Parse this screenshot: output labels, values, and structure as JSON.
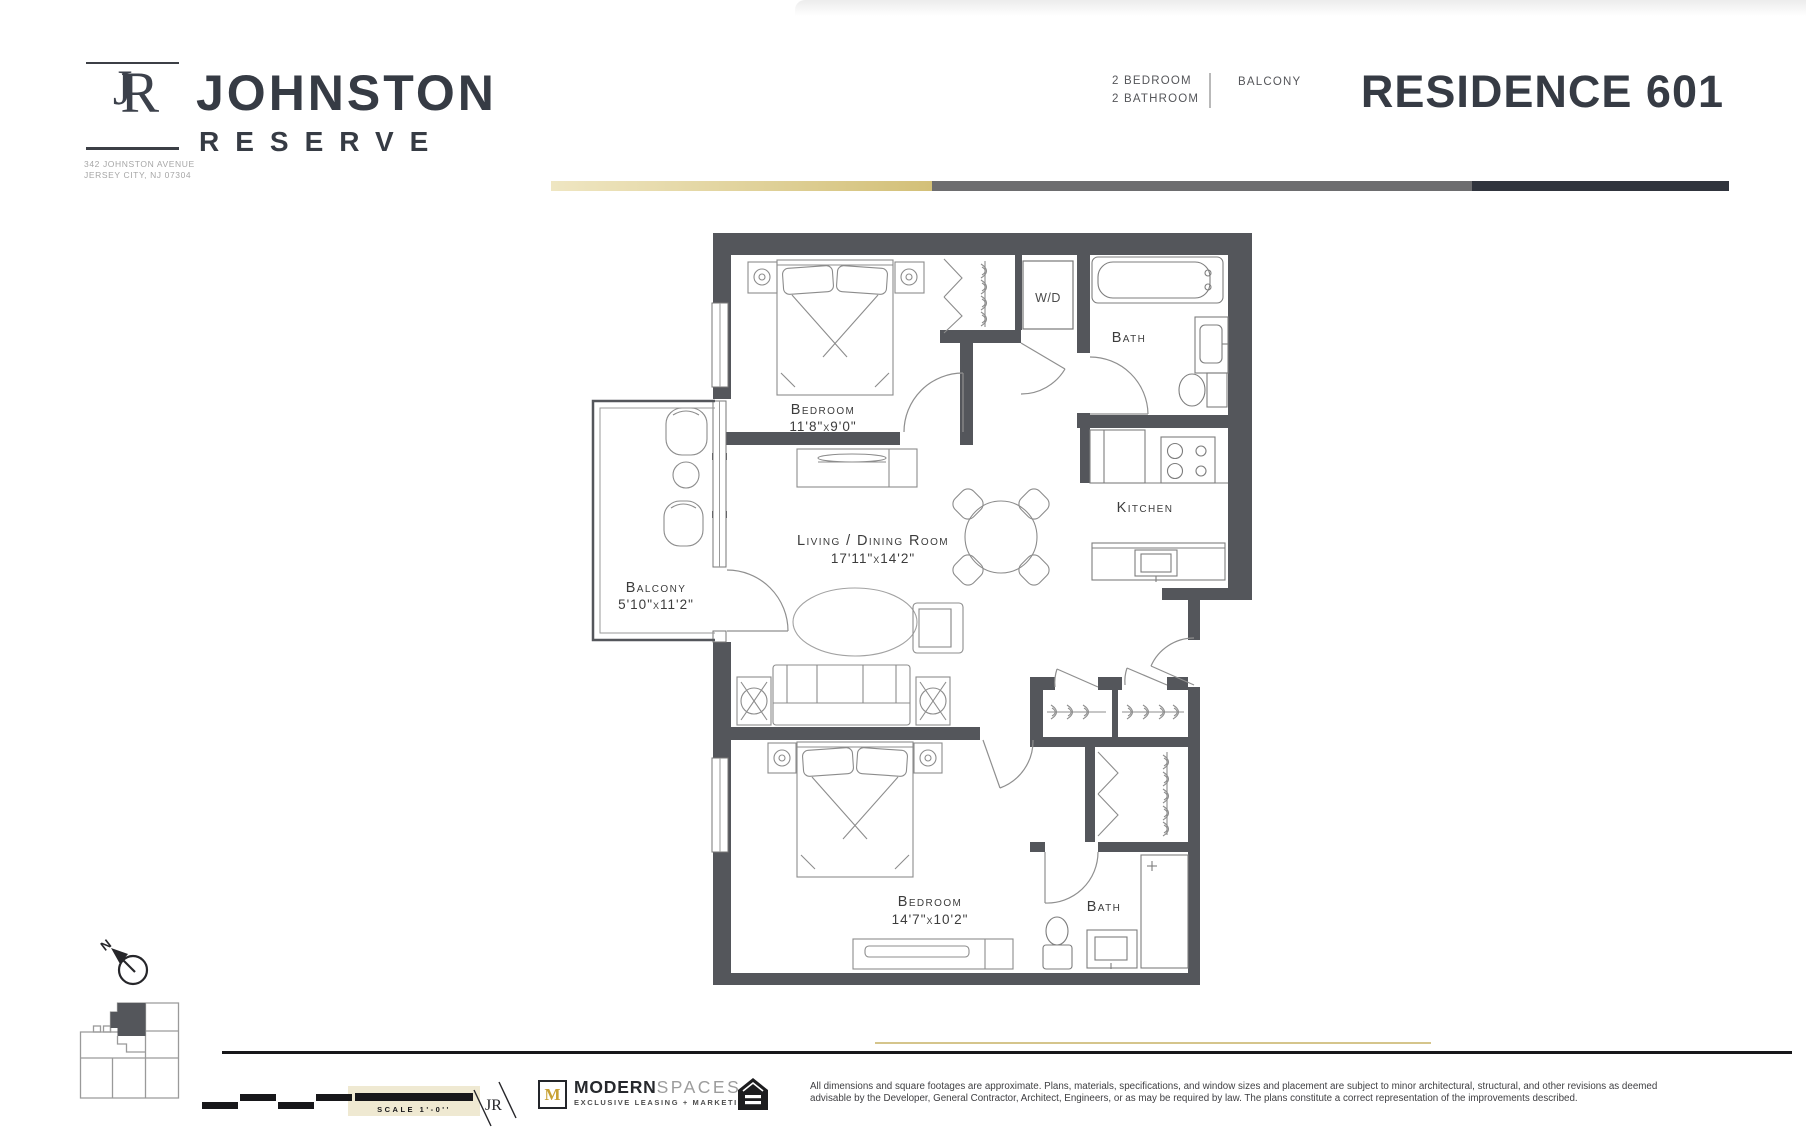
{
  "header": {
    "logo": {
      "monogram_j": "J",
      "monogram_r": "R",
      "name_line1": "JOHNSTON",
      "name_line2": "RESERVE",
      "address_line1": "342 JOHNSTON AVENUE",
      "address_line2": "JERSEY CITY, NJ 07304"
    },
    "unit_info": {
      "bedrooms": "2 BEDROOM",
      "bathrooms": "2 BATHROOM",
      "feature": "BALCONY"
    },
    "residence_title": "RESIDENCE 601",
    "accent_colors": {
      "gold": "#d3c078",
      "gray": "#6d6d6f",
      "dark": "#30343d"
    }
  },
  "floor_plan": {
    "wall_color": "#54565b",
    "bedroom1": {
      "name": "Bedroom",
      "dims": "11'8\"x9'0\""
    },
    "bath1": {
      "name": "Bath"
    },
    "kitchen": {
      "name": "Kitchen"
    },
    "living": {
      "name": "Living / Dining Room",
      "dims": "17'11\"x14'2\""
    },
    "balcony": {
      "name": "Balcony",
      "dims": "5'10\"x11'2\""
    },
    "bedroom2": {
      "name": "Bedroom",
      "dims": "14'7\"x10'2\""
    },
    "bath2": {
      "name": "Bath"
    },
    "washer_dryer": "W/D"
  },
  "compass": {
    "north": "N"
  },
  "footer": {
    "scale_label": "SCALE 1'-0''",
    "jr_monogram": "JR",
    "agency_initial": "M",
    "agency_bold": "MODERN",
    "agency_light": "SPACES",
    "agency_tagline": "EXCLUSIVE LEASING + MARKETING",
    "disclaimer_line1": "All dimensions and square footages are approximate. Plans, materials, specifications, and window sizes and placement are subject to minor architectural, structural, and other revisions as deemed",
    "disclaimer_line2": "advisable by the Developer, General Contractor, Architect, Engineers, or as may be required by law. The plans constitute a correct representation of the improvements described."
  }
}
